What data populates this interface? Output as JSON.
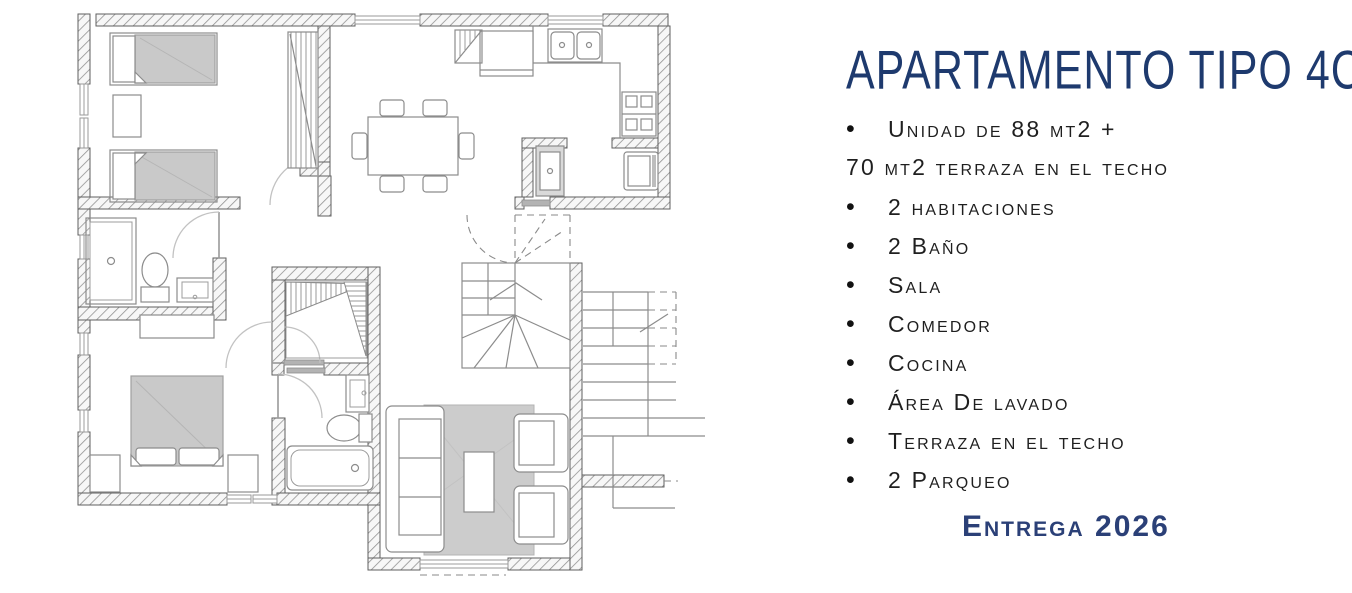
{
  "panel": {
    "title": "APARTAMENTO TIPO 4C",
    "bullet_glyph": "•",
    "features": [
      {
        "bullet": true,
        "text": "Unidad de 88 mt2 +"
      },
      {
        "bullet": false,
        "text": "70 mt2 terraza en el techo"
      },
      {
        "bullet": true,
        "text": "2 habitaciones"
      },
      {
        "bullet": true,
        "text": "2 Baño"
      },
      {
        "bullet": true,
        "text": "Sala"
      },
      {
        "bullet": true,
        "text": "Comedor"
      },
      {
        "bullet": true,
        "text": "Cocina"
      },
      {
        "bullet": true,
        "text": "Área De lavado"
      },
      {
        "bullet": true,
        "text": "Terraza en el techo"
      },
      {
        "bullet": true,
        "text": "2 Parqueo"
      }
    ],
    "delivery": "Entrega 2026"
  },
  "colors": {
    "title_blue": "#1e3a6e",
    "delivery_blue": "#2b4077",
    "body_text": "#1f1f1f",
    "plan_wall_edge": "#5f5f5f",
    "plan_line": "#8c8c8c",
    "furniture_gray": "#c9c9c9"
  },
  "floor_plan": {
    "type": "architectural-plan",
    "elements": [
      "twin-bed",
      "twin-bed",
      "nightstand",
      "bedroom-closet",
      "dining-table",
      "dining-chairs-6",
      "refrigerator",
      "pantry-shelf",
      "kitchen-counter",
      "double-sink",
      "stove-4-burners",
      "laundry-sink",
      "washer",
      "shower",
      "toilet",
      "bathroom-sink",
      "double-bed",
      "nightstand",
      "nightstand",
      "dresser",
      "walk-in-closet",
      "bathroom-sink",
      "toilet",
      "bathtub",
      "sofa",
      "armchair",
      "armchair",
      "coffee-table",
      "rug",
      "interior-winder-stairs",
      "exterior-stairs",
      "doors",
      "windows"
    ]
  }
}
